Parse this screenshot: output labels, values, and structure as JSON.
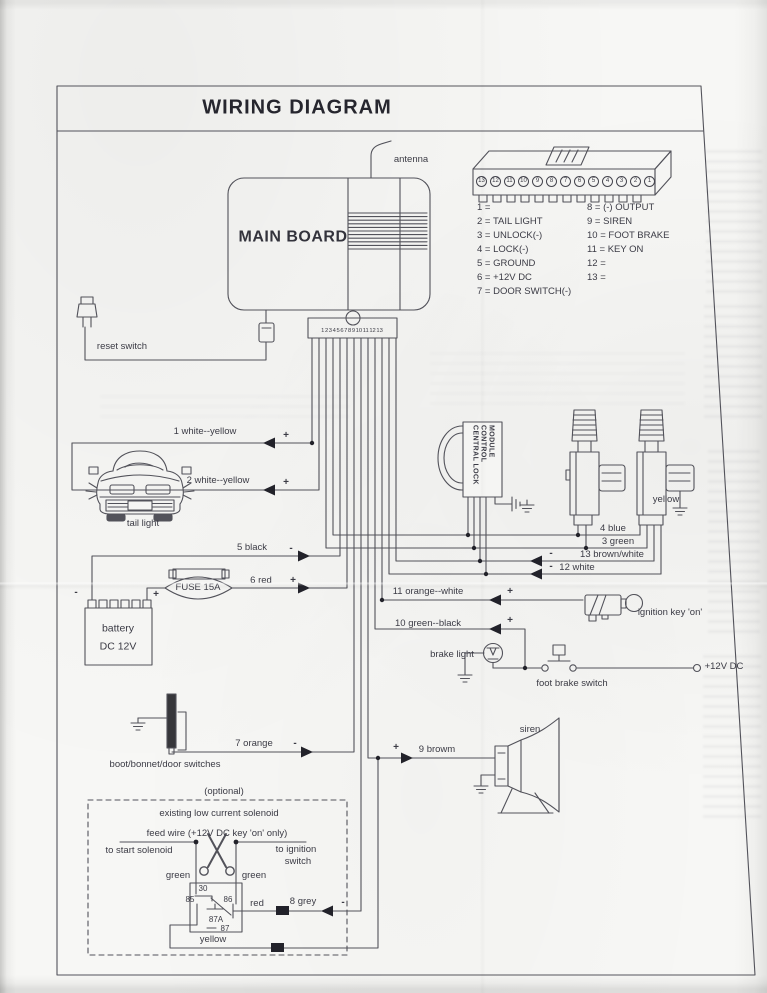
{
  "title": "WIRING DIAGRAM",
  "board": {
    "label": "MAIN BOARD",
    "antenna": "antenna"
  },
  "connector": {
    "pins": [
      "13",
      "12",
      "11",
      "10",
      "9",
      "8",
      "7",
      "6",
      "5",
      "4",
      "3",
      "2",
      "1"
    ],
    "legend_left": [
      "1 =",
      "2 = TAIL LIGHT",
      "3 = UNLOCK(-)",
      "4 = LOCK(-)",
      "5 = GROUND",
      "6 = +12V DC",
      "7 = DOOR SWITCH(-)"
    ],
    "legend_right": [
      "8 = (-) OUTPUT",
      "9 = SIREN",
      "10 = FOOT BRAKE",
      "11 = KEY ON",
      "12 =",
      "13 ="
    ]
  },
  "strip": {
    "pins": "1 2 3 4 5 6 7 8 9 10 11 12 13"
  },
  "wires": {
    "w1": {
      "label": "1 white--yellow",
      "sign": "+"
    },
    "w2": {
      "label": "2 white--yellow",
      "sign": "+"
    },
    "w3": {
      "label": "3 green",
      "sign": ""
    },
    "w4": {
      "label": "4 blue",
      "sign": ""
    },
    "w5": {
      "label": "5 black",
      "sign": "-"
    },
    "w6": {
      "label": "6 red",
      "sign": "+"
    },
    "w7": {
      "label": "7 orange",
      "sign": "-"
    },
    "w8": {
      "label": "8 grey",
      "sign": "-"
    },
    "w9": {
      "label": "9 browm",
      "sign": "+"
    },
    "w10": {
      "label": "10 green--black",
      "sign": "+"
    },
    "w11": {
      "label": "11 orange--white",
      "sign": "+"
    },
    "w12": {
      "label": "12 white",
      "sign": "-"
    },
    "w13": {
      "label": "13 brown/white",
      "sign": "-"
    }
  },
  "components": {
    "reset_switch": "reset switch",
    "tail_light": "tail light",
    "battery": [
      "battery",
      "DC 12V"
    ],
    "battery_minus": "-",
    "battery_plus": "+",
    "fuse": "FUSE 15A",
    "module": [
      "CENTRAL LOCK",
      "CONTROL",
      "MODULE"
    ],
    "actuator_yellow": "yellow",
    "ignition_key": "ignition key 'on'",
    "brake_light": "brake light",
    "foot_brake_switch": "foot brake switch",
    "plus12_foot_brake": "+12V DC",
    "boot_switches": "boot/bonnet/door switches",
    "siren": "siren"
  },
  "optional": {
    "caption": "(optional)",
    "heading1": "existing low current solenoid",
    "heading2": "feed wire (+12V DC key 'on' only)",
    "to_start": "to start solenoid",
    "to_ignition": "to ignition",
    "to_ignition2": "switch",
    "green_left": "green",
    "green_right": "green",
    "red": "red",
    "yellow": "yellow",
    "relay": {
      "p30": "30",
      "p85": "85",
      "p86": "86",
      "p87a": "87A",
      "p87": "87"
    }
  }
}
